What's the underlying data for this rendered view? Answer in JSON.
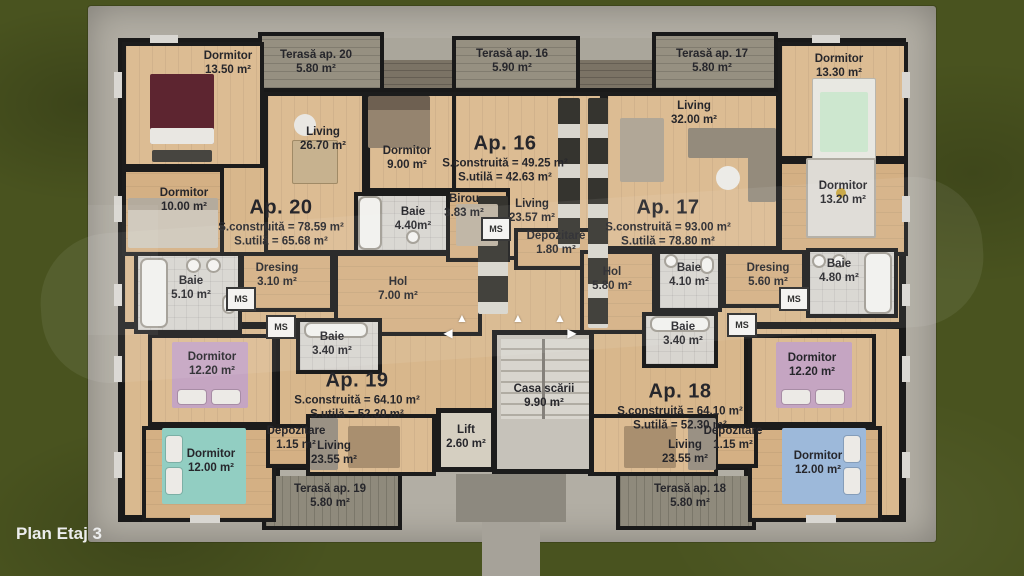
{
  "plan_title": "Plan Etaj 3",
  "ms_label": "MS",
  "icons": {
    "arrow_up": "▲",
    "arrow_left": "◀",
    "arrow_right": "▶"
  },
  "apartments": {
    "ap16": {
      "name": "Ap. 16",
      "built": "S.construită = 49.25 m²",
      "usable": "S.utilă = 42.63 m²"
    },
    "ap17": {
      "name": "Ap. 17",
      "built": "S.construită = 93.00 m²",
      "usable": "S.utilă = 78.80 m²"
    },
    "ap18": {
      "name": "Ap. 18",
      "built": "S.construită = 64.10 m²",
      "usable": "S.utilă = 52.30 m²"
    },
    "ap19": {
      "name": "Ap. 19",
      "built": "S.construită = 64.10 m²",
      "usable": "S.utilă = 52.30 m²"
    },
    "ap20": {
      "name": "Ap. 20",
      "built": "S.construită = 78.59 m²",
      "usable": "S.utilă = 65.68 m²"
    }
  },
  "rooms": {
    "a20_dormitor1": {
      "name": "Dormitor",
      "area": "13.50 m²"
    },
    "a20_dormitor2": {
      "name": "Dormitor",
      "area": "10.00 m²"
    },
    "a20_living": {
      "name": "Living",
      "area": "26.70 m²"
    },
    "a20_baie": {
      "name": "Baie",
      "area": "5.10 m²"
    },
    "a20_dresing": {
      "name": "Dresing",
      "area": "3.10 m²"
    },
    "a20_hol": {
      "name": "Hol",
      "area": "7.00 m²"
    },
    "a16_dormitor": {
      "name": "Dormitor",
      "area": "9.00 m²"
    },
    "a16_baie": {
      "name": "Baie",
      "area": "4.40m²"
    },
    "a16_birou": {
      "name": "Birou",
      "area": "3.83 m²"
    },
    "a16_living": {
      "name": "Living",
      "area": "23.57 m²"
    },
    "a16_depozitare": {
      "name": "Depozitare",
      "area": "1.80 m²"
    },
    "a17_living": {
      "name": "Living",
      "area": "32.00 m²"
    },
    "a17_dormitor1": {
      "name": "Dormitor",
      "area": "13.30 m²"
    },
    "a17_dormitor2": {
      "name": "Dormitor",
      "area": "13.20 m²"
    },
    "a17_hol": {
      "name": "Hol",
      "area": "5.80 m²"
    },
    "a17_baie1": {
      "name": "Baie",
      "area": "4.10 m²"
    },
    "a17_dresing": {
      "name": "Dresing",
      "area": "5.60 m²"
    },
    "a17_baie2": {
      "name": "Baie",
      "area": "4.80 m²"
    },
    "a19_dormitor1": {
      "name": "Dormitor",
      "area": "12.20 m²"
    },
    "a19_dormitor2": {
      "name": "Dormitor",
      "area": "12.00 m²"
    },
    "a19_baie": {
      "name": "Baie",
      "area": "3.40 m²"
    },
    "a19_depozitare": {
      "name": "Depozitare",
      "area": "1.15 m²"
    },
    "a19_living": {
      "name": "Living",
      "area": "23.55 m²"
    },
    "a18_dormitor1": {
      "name": "Dormitor",
      "area": "12.20 m²"
    },
    "a18_dormitor2": {
      "name": "Dormitor",
      "area": "12.00 m²"
    },
    "a18_baie": {
      "name": "Baie",
      "area": "3.40 m²"
    },
    "a18_depozitare": {
      "name": "Depozitare",
      "area": "1.15 m²"
    },
    "a18_living": {
      "name": "Living",
      "area": "23.55 m²"
    },
    "casa_scarii": {
      "name": "Casa scării",
      "area": "9.90 m²"
    },
    "lift": {
      "name": "Lift",
      "area": "2.60 m²"
    }
  },
  "terraces": {
    "t20": {
      "name": "Terasă ap. 20",
      "area": "5.80 m²"
    },
    "t16": {
      "name": "Terasă ap. 16",
      "area": "5.90 m²"
    },
    "t17": {
      "name": "Terasă ap. 17",
      "area": "5.80 m²"
    },
    "t19": {
      "name": "Terasă ap. 19",
      "area": "5.80 m²"
    },
    "t18": {
      "name": "Terasă ap. 18",
      "area": "5.80 m²"
    }
  },
  "colors": {
    "grass": "#49531f",
    "concrete": "#b2aea4",
    "wall": "#191919",
    "wood_floor": "#d8b78c",
    "bath_tile": "#d8d5d0",
    "deck": "#8f8a7c",
    "bed_maroon": "#5d2530",
    "bed_green": "#cde7cf",
    "bed_pink": "#c5a5c2",
    "bed_teal": "#92cec2",
    "bed_blue": "#9db9da",
    "label_text": "#26262b"
  }
}
